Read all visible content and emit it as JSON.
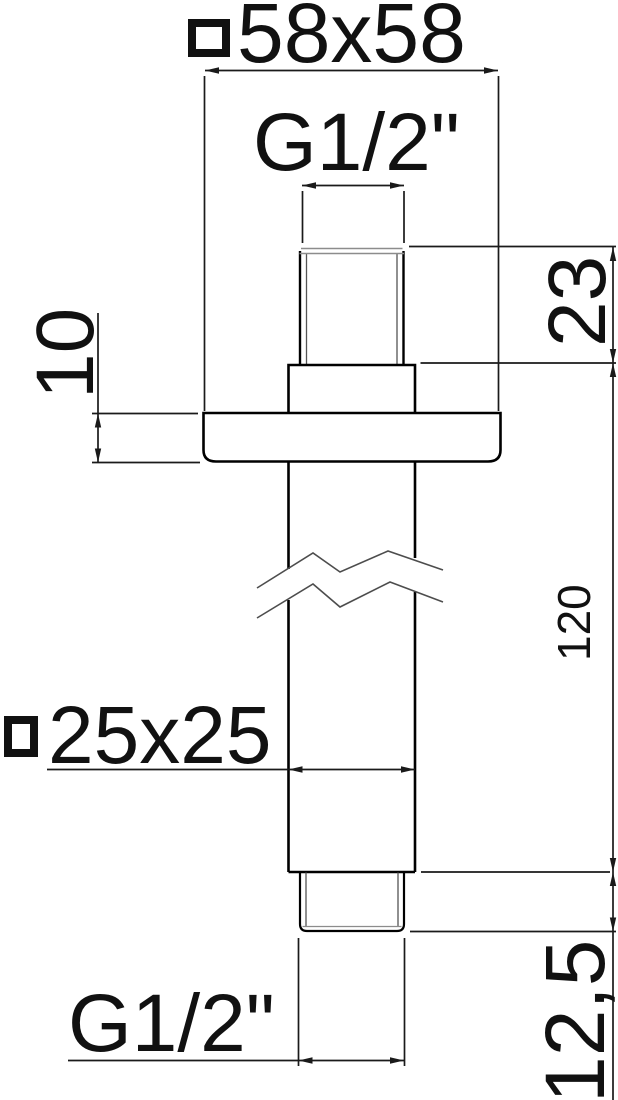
{
  "drawing": {
    "type": "technical-dimension-drawing",
    "labels": {
      "flange_size": "58x58",
      "top_thread": "G1/2\"",
      "top_thread_length": "23",
      "flange_thickness": "10",
      "arm_length": "120",
      "tube_size": "25x25",
      "bottom_thread": "G1/2\"",
      "bottom_thread_length": "12,5"
    },
    "icons": {
      "square_section_symbol": "square-outline"
    },
    "colors": {
      "outline": "#000000",
      "dimension_line": "#1a1a1a",
      "thin_thread_line": "#8c8c8c",
      "break_line": "#4d4d4d",
      "text": "#111111",
      "background": "#ffffff"
    }
  }
}
